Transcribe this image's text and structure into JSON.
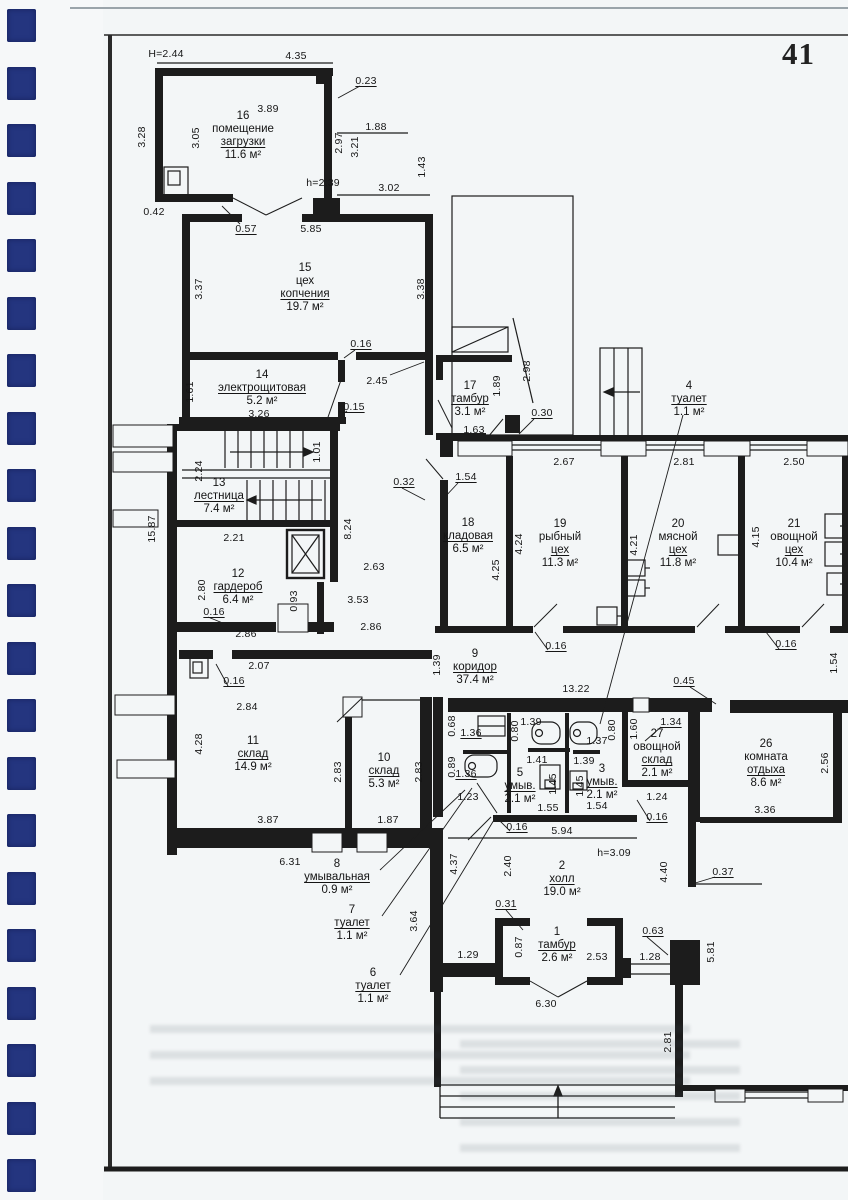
{
  "page": {
    "number": "41"
  },
  "colors": {
    "ink": "#1d1d1d",
    "paper": "#f3f6f7",
    "binding": "#24357f"
  },
  "plan": {
    "rooms": [
      {
        "num": "16",
        "name": [
          "помещение",
          "загрузки"
        ],
        "area": "11.6 м²",
        "x": 243,
        "y": 110
      },
      {
        "num": "15",
        "name": [
          "цех",
          "копчения"
        ],
        "area": "19.7 м²",
        "x": 305,
        "y": 262
      },
      {
        "num": "14",
        "name": [
          "электрощитовая"
        ],
        "area": "5.2 м²",
        "x": 262,
        "y": 369
      },
      {
        "num": "17",
        "name": [
          "тамбур"
        ],
        "area": "3.1 м²",
        "x": 470,
        "y": 380
      },
      {
        "num": "4",
        "name": [
          "туалет"
        ],
        "area": "1.1 м²",
        "x": 689,
        "y": 380
      },
      {
        "num": "13",
        "name": [
          "лестница"
        ],
        "area": "7.4 м²",
        "x": 219,
        "y": 477
      },
      {
        "num": "18",
        "name": [
          "кладовая"
        ],
        "area": "6.5 м²",
        "x": 468,
        "y": 517
      },
      {
        "num": "19",
        "name": [
          "рыбный",
          "цех"
        ],
        "area": "11.3 м²",
        "x": 560,
        "y": 518
      },
      {
        "num": "20",
        "name": [
          "мясной",
          "цех"
        ],
        "area": "11.8 м²",
        "x": 678,
        "y": 518
      },
      {
        "num": "21",
        "name": [
          "овощной",
          "цех"
        ],
        "area": "10.4 м²",
        "x": 794,
        "y": 518
      },
      {
        "num": "12",
        "name": [
          "гардероб"
        ],
        "area": "6.4 м²",
        "x": 238,
        "y": 568
      },
      {
        "num": "9",
        "name": [
          "коридор"
        ],
        "area": "37.4 м²",
        "x": 475,
        "y": 648
      },
      {
        "num": "11",
        "name": [
          "склад"
        ],
        "area": "14.9 м²",
        "x": 253,
        "y": 735
      },
      {
        "num": "10",
        "name": [
          "склад"
        ],
        "area": "5.3 м²",
        "x": 384,
        "y": 752
      },
      {
        "num": "27",
        "name": [
          "овощной",
          "склад"
        ],
        "area": "2.1 м²",
        "x": 657,
        "y": 728
      },
      {
        "num": "26",
        "name": [
          "комната",
          "отдыха"
        ],
        "area": "8.6 м²",
        "x": 766,
        "y": 738
      },
      {
        "num": "5",
        "name": [
          "умыв."
        ],
        "area": "2.1 м²",
        "x": 520,
        "y": 767
      },
      {
        "num": "3",
        "name": [
          "умыв."
        ],
        "area": "2.1 м²",
        "x": 602,
        "y": 763
      },
      {
        "num": "8",
        "name": [
          "умывальная"
        ],
        "area": "0.9 м²",
        "x": 337,
        "y": 858
      },
      {
        "num": "7",
        "name": [
          "туалет"
        ],
        "area": "1.1 м²",
        "x": 352,
        "y": 904
      },
      {
        "num": "6",
        "name": [
          "туалет"
        ],
        "area": "1.1 м²",
        "x": 373,
        "y": 967
      },
      {
        "num": "2",
        "name": [
          "холл"
        ],
        "area": "19.0 м²",
        "x": 562,
        "y": 860
      },
      {
        "num": "1",
        "name": [
          "тамбур"
        ],
        "area": "2.6 м²",
        "x": 557,
        "y": 926
      }
    ],
    "dims": [
      {
        "t": "H=2.44",
        "x": 166,
        "y": 54
      },
      {
        "t": "4.35",
        "x": 296,
        "y": 56
      },
      {
        "t": "0.23",
        "x": 366,
        "y": 81,
        "u": 1
      },
      {
        "t": "3.89",
        "x": 268,
        "y": 109
      },
      {
        "t": "3.28",
        "x": 142,
        "y": 137,
        "r": 1
      },
      {
        "t": "3.05",
        "x": 196,
        "y": 138,
        "r": 1
      },
      {
        "t": "2.97",
        "x": 339,
        "y": 143,
        "r": 1
      },
      {
        "t": "3.21",
        "x": 355,
        "y": 147,
        "r": 1
      },
      {
        "t": "1.88",
        "x": 376,
        "y": 127
      },
      {
        "t": "1.43",
        "x": 422,
        "y": 167,
        "r": 1
      },
      {
        "t": "3.02",
        "x": 389,
        "y": 188
      },
      {
        "t": "h=2.39",
        "x": 323,
        "y": 183
      },
      {
        "t": "0.42",
        "x": 154,
        "y": 212
      },
      {
        "t": "0.57",
        "x": 246,
        "y": 229,
        "u": 1
      },
      {
        "t": "5.85",
        "x": 311,
        "y": 229
      },
      {
        "t": "3.37",
        "x": 199,
        "y": 289,
        "r": 1
      },
      {
        "t": "3.38",
        "x": 421,
        "y": 289,
        "r": 1
      },
      {
        "t": "0.16",
        "x": 361,
        "y": 344,
        "u": 1
      },
      {
        "t": "2.45",
        "x": 377,
        "y": 381
      },
      {
        "t": "1.89",
        "x": 497,
        "y": 386,
        "r": 1
      },
      {
        "t": "2.98",
        "x": 527,
        "y": 371,
        "r": 1
      },
      {
        "t": "1.61",
        "x": 190,
        "y": 392,
        "r": 1
      },
      {
        "t": "3.26",
        "x": 259,
        "y": 414
      },
      {
        "t": "0.15",
        "x": 354,
        "y": 407,
        "u": 1
      },
      {
        "t": "1.63",
        "x": 474,
        "y": 430
      },
      {
        "t": "0.30",
        "x": 542,
        "y": 413,
        "u": 1
      },
      {
        "t": "0.32",
        "x": 404,
        "y": 482,
        "u": 1
      },
      {
        "t": "1.54",
        "x": 466,
        "y": 477,
        "u": 1
      },
      {
        "t": "2.67",
        "x": 564,
        "y": 462
      },
      {
        "t": "2.81",
        "x": 684,
        "y": 462
      },
      {
        "t": "2.50",
        "x": 794,
        "y": 462
      },
      {
        "t": "1.01",
        "x": 317,
        "y": 452,
        "r": 1
      },
      {
        "t": "2.24",
        "x": 199,
        "y": 471,
        "r": 1
      },
      {
        "t": "15.87",
        "x": 152,
        "y": 529,
        "r": 1
      },
      {
        "t": "2.21",
        "x": 234,
        "y": 538
      },
      {
        "t": "8.24",
        "x": 348,
        "y": 529,
        "r": 1
      },
      {
        "t": "2.80",
        "x": 202,
        "y": 590,
        "r": 1
      },
      {
        "t": "2.63",
        "x": 374,
        "y": 567
      },
      {
        "t": "0.93",
        "x": 294,
        "y": 601,
        "r": 1
      },
      {
        "t": "3.53",
        "x": 358,
        "y": 600
      },
      {
        "t": "0.16",
        "x": 214,
        "y": 612,
        "u": 1
      },
      {
        "t": "2.86",
        "x": 246,
        "y": 634
      },
      {
        "t": "2.86",
        "x": 371,
        "y": 627
      },
      {
        "t": "4.24",
        "x": 519,
        "y": 544,
        "r": 1
      },
      {
        "t": "4.25",
        "x": 496,
        "y": 570,
        "r": 1
      },
      {
        "t": "4.21",
        "x": 634,
        "y": 545,
        "r": 1
      },
      {
        "t": "4.15",
        "x": 756,
        "y": 537,
        "r": 1
      },
      {
        "t": "0.16",
        "x": 556,
        "y": 646,
        "u": 1
      },
      {
        "t": "0.16",
        "x": 786,
        "y": 644,
        "u": 1
      },
      {
        "t": "1.39",
        "x": 437,
        "y": 665,
        "r": 1
      },
      {
        "t": "13.22",
        "x": 576,
        "y": 689
      },
      {
        "t": "0.45",
        "x": 684,
        "y": 681,
        "u": 1
      },
      {
        "t": "1.54",
        "x": 834,
        "y": 663,
        "r": 1
      },
      {
        "t": "1.34",
        "x": 671,
        "y": 722,
        "u": 1
      },
      {
        "t": "0.68",
        "x": 452,
        "y": 726,
        "r": 1
      },
      {
        "t": "1.36",
        "x": 471,
        "y": 733,
        "u": 1
      },
      {
        "t": "0.80",
        "x": 515,
        "y": 731,
        "r": 1
      },
      {
        "t": "1.39",
        "x": 531,
        "y": 722
      },
      {
        "t": "0.80",
        "x": 612,
        "y": 730,
        "r": 1
      },
      {
        "t": "1.37",
        "x": 597,
        "y": 741
      },
      {
        "t": "1.60",
        "x": 634,
        "y": 729,
        "r": 1
      },
      {
        "t": "0.89",
        "x": 452,
        "y": 767,
        "r": 1
      },
      {
        "t": "1.36",
        "x": 466,
        "y": 774,
        "u": 1
      },
      {
        "t": "1.41",
        "x": 537,
        "y": 760
      },
      {
        "t": "1.39",
        "x": 584,
        "y": 761
      },
      {
        "t": "1.45",
        "x": 553,
        "y": 784,
        "r": 1
      },
      {
        "t": "1.45",
        "x": 580,
        "y": 786,
        "r": 1
      },
      {
        "t": "1.23",
        "x": 468,
        "y": 797
      },
      {
        "t": "1.55",
        "x": 548,
        "y": 808
      },
      {
        "t": "1.54",
        "x": 597,
        "y": 806
      },
      {
        "t": "1.24",
        "x": 657,
        "y": 797
      },
      {
        "t": "0.16",
        "x": 517,
        "y": 827,
        "u": 1
      },
      {
        "t": "5.94",
        "x": 562,
        "y": 831
      },
      {
        "t": "0.16",
        "x": 657,
        "y": 817,
        "u": 1
      },
      {
        "t": "2.56",
        "x": 825,
        "y": 763,
        "r": 1
      },
      {
        "t": "3.36",
        "x": 765,
        "y": 810
      },
      {
        "t": "2.07",
        "x": 259,
        "y": 666
      },
      {
        "t": "0.16",
        "x": 234,
        "y": 681,
        "u": 1
      },
      {
        "t": "2.84",
        "x": 247,
        "y": 707
      },
      {
        "t": "4.28",
        "x": 199,
        "y": 744,
        "r": 1
      },
      {
        "t": "2.83",
        "x": 338,
        "y": 772,
        "r": 1
      },
      {
        "t": "2.83",
        "x": 419,
        "y": 772,
        "r": 1
      },
      {
        "t": "3.87",
        "x": 268,
        "y": 820
      },
      {
        "t": "1.87",
        "x": 388,
        "y": 820
      },
      {
        "t": "6.31",
        "x": 290,
        "y": 862
      },
      {
        "t": "4.37",
        "x": 454,
        "y": 864,
        "r": 1
      },
      {
        "t": "3.64",
        "x": 414,
        "y": 921,
        "r": 1
      },
      {
        "t": "2.40",
        "x": 508,
        "y": 866,
        "r": 1
      },
      {
        "t": "h=3.09",
        "x": 614,
        "y": 853
      },
      {
        "t": "4.40",
        "x": 664,
        "y": 872,
        "r": 1
      },
      {
        "t": "0.37",
        "x": 723,
        "y": 872,
        "u": 1
      },
      {
        "t": "0.31",
        "x": 506,
        "y": 904,
        "u": 1
      },
      {
        "t": "1.29",
        "x": 468,
        "y": 955
      },
      {
        "t": "0.87",
        "x": 519,
        "y": 947,
        "r": 1
      },
      {
        "t": "2.53",
        "x": 597,
        "y": 957
      },
      {
        "t": "0.63",
        "x": 653,
        "y": 931,
        "u": 1
      },
      {
        "t": "1.28",
        "x": 650,
        "y": 957
      },
      {
        "t": "5.81",
        "x": 711,
        "y": 952,
        "r": 1
      },
      {
        "t": "6.30",
        "x": 546,
        "y": 1004
      },
      {
        "t": "2.81",
        "x": 668,
        "y": 1042,
        "r": 1
      }
    ]
  }
}
